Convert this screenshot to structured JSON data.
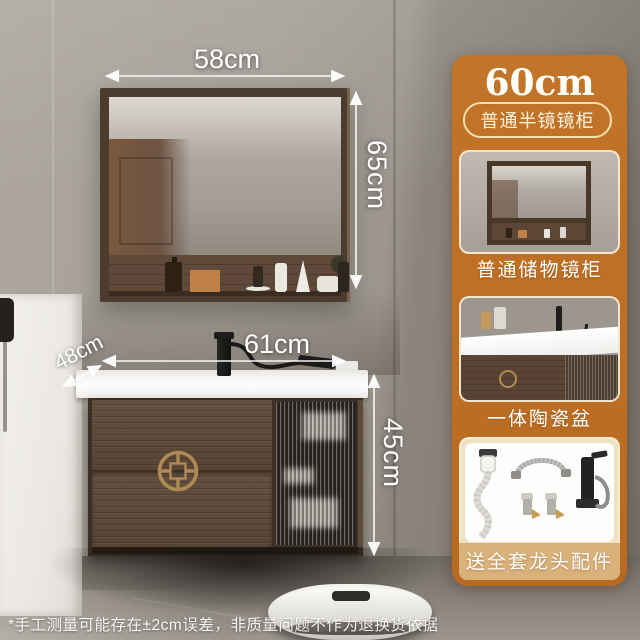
{
  "product": {
    "size_title": "60cm",
    "variant_badge": "普通半镜镜柜",
    "options": [
      {
        "label": "普通储物镜柜"
      },
      {
        "label": "一体陶瓷盆"
      },
      {
        "label": "送全套龙头配件"
      }
    ]
  },
  "annotations": {
    "mirror_width": "58cm",
    "mirror_height": "65cm",
    "counter_width": "61cm",
    "counter_depth": "48cm",
    "cabinet_height": "45cm",
    "disclaimer": "*手工测量可能存在±2cm误差，非质量问题不作为退换货依据"
  },
  "colors": {
    "panel_background": "#bd6f26",
    "badge_border": "#f3e0b0",
    "card_label_strip": "#d9b27b",
    "annotation_text": "#ffffff",
    "cabinet_wood": "#5a4536",
    "counter_white": "#f5f4f2",
    "brass_handle": "#b08a55",
    "wall_gray": "#a29c94"
  }
}
